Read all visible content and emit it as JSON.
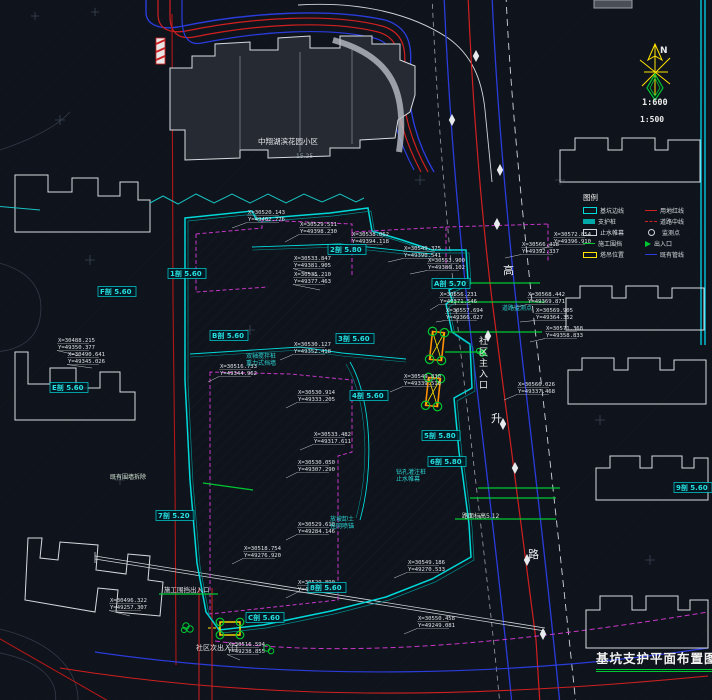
{
  "meta": {
    "title": "基坑支护平面布置图",
    "scale_primary": "1:600",
    "scale_secondary": "1:500",
    "north_label": "N"
  },
  "colors": {
    "background": "#0f131b",
    "pit_cyan": "#00d9d9",
    "road_red": "#d02020",
    "utility_blue": "#2a3cdc",
    "zone_magenta": "#c837c8",
    "annotation_green": "#00c832",
    "crane_orange": "#ff9000",
    "crane_yellow": "#ffe400",
    "building_white": "#d7dbe0"
  },
  "legend": {
    "title": "图例",
    "col1": [
      {
        "label": "基坑边线"
      },
      {
        "label": "支护桩"
      },
      {
        "label": "止水帷幕"
      },
      {
        "label": "施工围挡"
      },
      {
        "label": "塔吊位置"
      }
    ],
    "col2": [
      {
        "label": "用地红线"
      },
      {
        "label": "道路中线"
      },
      {
        "label": "监测点"
      },
      {
        "label": "出入口"
      },
      {
        "label": "既有管线"
      }
    ]
  },
  "road": {
    "name_char_1": "高",
    "name_char_2": "升",
    "name_char_3": "路"
  },
  "siteTexts": {
    "complex_name": "中翔湖滨花园小区",
    "complex_elev": "15.25",
    "main_entrance": "社区主入口",
    "secondary_entrance": "社区次出入口",
    "fence_gate": "施工围挡出入口",
    "wall_note": "既有围墙拆除",
    "road_level": "路面标高5.12"
  },
  "sectionLabels": [
    {
      "x": 100,
      "y": 294,
      "text": "F剖 5.60"
    },
    {
      "x": 170,
      "y": 276,
      "text": "1剖 5.60"
    },
    {
      "x": 212,
      "y": 338,
      "text": "B剖 5.60"
    },
    {
      "x": 330,
      "y": 252,
      "text": "2剖 5.80"
    },
    {
      "x": 434,
      "y": 286,
      "text": "A剖 5.70"
    },
    {
      "x": 338,
      "y": 341,
      "text": "3剖 5.60"
    },
    {
      "x": 52,
      "y": 390,
      "text": "E剖 5.60"
    },
    {
      "x": 352,
      "y": 398,
      "text": "4剖 5.60"
    },
    {
      "x": 424,
      "y": 438,
      "text": "5剖 5.80"
    },
    {
      "x": 430,
      "y": 464,
      "text": "6剖 5.80"
    },
    {
      "x": 158,
      "y": 518,
      "text": "7剖 5.20"
    },
    {
      "x": 310,
      "y": 590,
      "text": "8剖 5.60"
    },
    {
      "x": 676,
      "y": 490,
      "text": "9剖 5.60"
    },
    {
      "x": 248,
      "y": 620,
      "text": "C剖 5.60"
    }
  ],
  "noteLabels": [
    {
      "x": 246,
      "y": 358,
      "l1": "双轴搅拌桩",
      "l2": "重力式挡墙"
    },
    {
      "x": 396,
      "y": 474,
      "l1": "钻孔灌注桩",
      "l2": "止水帷幕"
    },
    {
      "x": 330,
      "y": 521,
      "l1": "放坡卸土",
      "l2": "挂网喷锚"
    },
    {
      "x": 502,
      "y": 310,
      "l1": "道路监测点",
      "l2": ""
    }
  ],
  "coordLabels": [
    {
      "lx": 248,
      "ly": 214,
      "tx": 232,
      "ty": 228,
      "x": "X=30520.143",
      "y": "Y=49402.776"
    },
    {
      "lx": 300,
      "ly": 226,
      "tx": 285,
      "ty": 242,
      "x": "X=30529.511",
      "y": "Y=49398.230"
    },
    {
      "lx": 352,
      "ly": 236,
      "tx": 338,
      "ty": 250,
      "x": "X=30538.062",
      "y": "Y=49394.118"
    },
    {
      "lx": 294,
      "ly": 260,
      "tx": 318,
      "ty": 276,
      "x": "X=30533.847",
      "y": "Y=49381.905"
    },
    {
      "lx": 294,
      "ly": 276,
      "tx": 320,
      "ty": 290,
      "x": "X=30535.210",
      "y": "Y=49377.463"
    },
    {
      "lx": 404,
      "ly": 250,
      "tx": 388,
      "ty": 262,
      "x": "X=30549.375",
      "y": "Y=49390.541"
    },
    {
      "lx": 428,
      "ly": 262,
      "tx": 410,
      "ty": 274,
      "x": "X=30553.900",
      "y": "Y=49386.102"
    },
    {
      "lx": 522,
      "ly": 246,
      "tx": 505,
      "ty": 258,
      "x": "X=30566.418",
      "y": "Y=49392.337"
    },
    {
      "lx": 554,
      "ly": 236,
      "tx": 540,
      "ty": 250,
      "x": "X=30572.854",
      "y": "Y=49396.910"
    },
    {
      "lx": 440,
      "ly": 296,
      "tx": 430,
      "ty": 310,
      "x": "X=30556.231",
      "y": "Y=49371.546"
    },
    {
      "lx": 446,
      "ly": 312,
      "tx": 436,
      "ty": 322,
      "x": "X=30557.694",
      "y": "Y=49366.027"
    },
    {
      "lx": 528,
      "ly": 296,
      "tx": 512,
      "ty": 308,
      "x": "X=30568.442",
      "y": "Y=49369.871"
    },
    {
      "lx": 536,
      "ly": 312,
      "tx": 520,
      "ty": 322,
      "x": "X=30569.905",
      "y": "Y=49364.352"
    },
    {
      "lx": 546,
      "ly": 330,
      "tx": 530,
      "ty": 342,
      "x": "X=30571.368",
      "y": "Y=49358.833"
    },
    {
      "lx": 294,
      "ly": 346,
      "tx": 280,
      "ty": 360,
      "x": "X=30530.127",
      "y": "Y=49352.418"
    },
    {
      "lx": 220,
      "ly": 368,
      "tx": 208,
      "ty": 382,
      "x": "X=30516.733",
      "y": "Y=49344.962"
    },
    {
      "lx": 58,
      "ly": 342,
      "tx": 80,
      "ty": 356,
      "x": "X=30488.215",
      "y": "Y=49350.377"
    },
    {
      "lx": 68,
      "ly": 356,
      "tx": 92,
      "ty": 368,
      "x": "X=30490.641",
      "y": "Y=49345.026"
    },
    {
      "lx": 404,
      "ly": 378,
      "tx": 390,
      "ty": 392,
      "x": "X=30549.830",
      "y": "Y=49339.518"
    },
    {
      "lx": 298,
      "ly": 394,
      "tx": 286,
      "ty": 408,
      "x": "X=30530.914",
      "y": "Y=49333.205"
    },
    {
      "lx": 314,
      "ly": 436,
      "tx": 300,
      "ty": 450,
      "x": "X=30533.482",
      "y": "Y=49317.611"
    },
    {
      "lx": 298,
      "ly": 464,
      "tx": 286,
      "ty": 478,
      "x": "X=30530.050",
      "y": "Y=49307.290"
    },
    {
      "lx": 298,
      "ly": 526,
      "tx": 286,
      "ty": 540,
      "x": "X=30529.618",
      "y": "Y=49284.146"
    },
    {
      "lx": 408,
      "ly": 564,
      "tx": 394,
      "ty": 578,
      "x": "X=30549.186",
      "y": "Y=49270.533"
    },
    {
      "lx": 244,
      "ly": 550,
      "tx": 232,
      "ty": 564,
      "x": "X=30518.754",
      "y": "Y=49276.920"
    },
    {
      "lx": 110,
      "ly": 602,
      "tx": 130,
      "ty": 616,
      "x": "X=30496.322",
      "y": "Y=49257.307"
    },
    {
      "lx": 298,
      "ly": 584,
      "tx": 286,
      "ty": 598,
      "x": "X=30529.890",
      "y": "Y=49263.694"
    },
    {
      "lx": 418,
      "ly": 620,
      "tx": 404,
      "ty": 634,
      "x": "X=30550.458",
      "y": "Y=49249.081"
    },
    {
      "lx": 518,
      "ly": 386,
      "tx": 504,
      "ty": 400,
      "x": "X=30566.026",
      "y": "Y=49337.468"
    },
    {
      "lx": 228,
      "ly": 646,
      "tx": 240,
      "ty": 660,
      "x": "X=30516.594",
      "y": "Y=49238.855"
    }
  ],
  "roadMarkers": [
    [
      500,
      170
    ],
    [
      497,
      224
    ],
    [
      488,
      336
    ],
    [
      503,
      424
    ],
    [
      515,
      468
    ],
    [
      527,
      560
    ],
    [
      543,
      634
    ],
    [
      476,
      56
    ],
    [
      452,
      120
    ]
  ]
}
